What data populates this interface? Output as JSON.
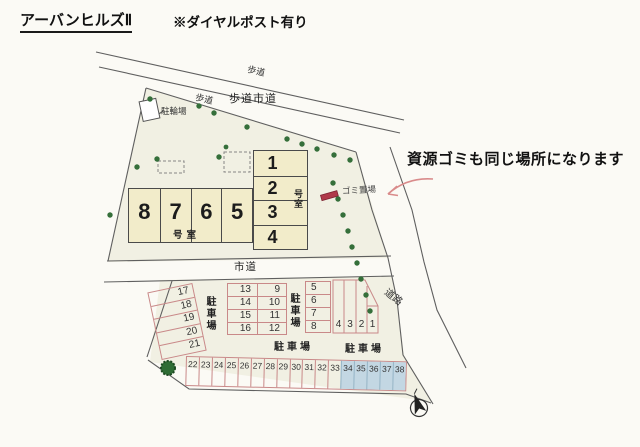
{
  "header": {
    "title": "アーバンヒルズⅡ",
    "note": "※ダイヤルポスト有り"
  },
  "annotation": {
    "recycle_note": "資源ゴミも同じ場所になります",
    "garbage_area": "ゴミ置場"
  },
  "roads": {
    "sidewalk": "歩道",
    "sidewalk_city": "歩道市道",
    "city_road": "市道",
    "road": "道路"
  },
  "facilities": {
    "bicycle_parking": "駐輪場",
    "unit_label": "号室"
  },
  "buildings": {
    "row_units": [
      "8",
      "7",
      "6",
      "5"
    ],
    "col_units": [
      "1",
      "2",
      "3",
      "4"
    ]
  },
  "parking": {
    "label": "駐車場",
    "left_block": [
      "17",
      "18",
      "19",
      "20",
      "21"
    ],
    "mid_block_left": [
      "13",
      "14",
      "15",
      "16"
    ],
    "mid_block_right": [
      "9",
      "10",
      "11",
      "12"
    ],
    "east_block": [
      "5",
      "6",
      "7",
      "8"
    ],
    "front_block": [
      "4",
      "3",
      "2",
      "1"
    ],
    "bottom_row": [
      "22",
      "23",
      "24",
      "25",
      "26",
      "27",
      "28",
      "29",
      "30",
      "31",
      "32",
      "33",
      "34",
      "35",
      "36",
      "37",
      "38"
    ]
  },
  "icons": {
    "north_arrow": "north-arrow-icon",
    "tree": "tree-icon",
    "garbage_marker": "garbage-marker-icon",
    "note_arrow": "arrow-pointer-icon"
  },
  "colors": {
    "parking_outline": "#c98989",
    "reserved_blue_fill": "#c3d7e3",
    "building_fill": "#f2ecca",
    "site_fill": "#f1f0e3",
    "tree_green": "#356f3a",
    "garbage_red": "#b03a4a",
    "arrow_pink": "#d98b8b"
  }
}
